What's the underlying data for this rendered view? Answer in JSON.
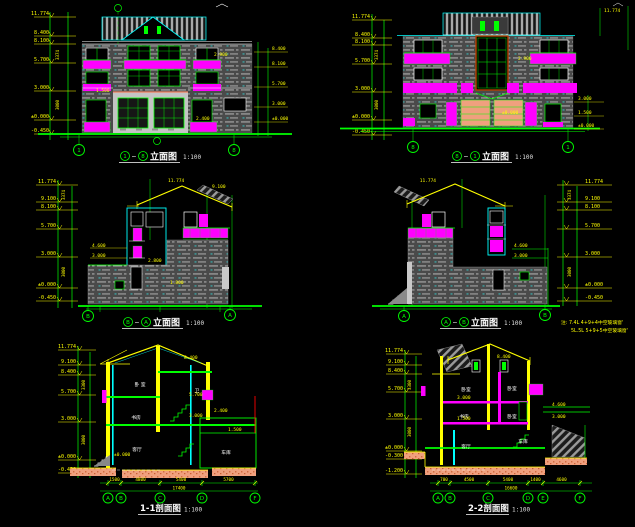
{
  "app": {
    "name": "cad-drawing-sheet",
    "background": "#000000"
  },
  "colors": {
    "line_green": "#00ff00",
    "dim_yellow": "#ffff00",
    "magenta": "#ff00ff",
    "cyan": "#00ffff",
    "white": "#ffffff",
    "wall_gray": "#4a4a4a",
    "light_wall": "#c4c4c4",
    "salmon": "#f0a07e",
    "frame_red": "#b44000"
  },
  "panels": {
    "front_elev": {
      "title": {
        "left_bubble": "1",
        "sep": "~",
        "right_bubble": "8",
        "name": "立面图",
        "scale": "1:100"
      },
      "axis_bubbles": [
        "1",
        "8"
      ],
      "levels_left": [
        "11.774",
        "8.400",
        "8.100",
        "5.700",
        "3.000",
        "±0.000",
        "-0.450"
      ],
      "levels_right": [
        "8.400",
        "8.100",
        "5.700",
        "3.000",
        "±0.000"
      ],
      "chain_dims": [
        "3374",
        "3000"
      ],
      "callouts": [
        "2.900",
        "1.500",
        "2.400"
      ]
    },
    "rear_elev": {
      "title": {
        "left_bubble": "8",
        "sep": "~",
        "right_bubble": "1",
        "name": "立面图",
        "scale": "1:100"
      },
      "axis_bubbles": [
        "8",
        "1"
      ],
      "levels_left": [
        "11.774",
        "8.400",
        "8.100",
        "5.700",
        "3.000",
        "±0.000",
        "-0.450"
      ],
      "levels_right": [
        "3.000",
        "1.500",
        "±0.000"
      ],
      "chain_dims": [
        "3374",
        "3000"
      ],
      "callouts": [
        "11.774",
        "2.900",
        "±0.000"
      ]
    },
    "left_elev": {
      "title": {
        "left_bubble": "B",
        "sep": "~",
        "right_bubble": "A",
        "name": "立面图",
        "scale": "1:100"
      },
      "axis_bubbles": [
        "B",
        "A"
      ],
      "levels_left": [
        "11.774",
        "9.100",
        "8.100",
        "5.700",
        "3.000",
        "±0.000",
        "-0.450"
      ],
      "chain_dims": [
        "3374",
        "3000"
      ],
      "callouts": [
        "11.774",
        "9.100",
        "4.600",
        "3.000",
        "2.800",
        "1.800"
      ]
    },
    "right_elev": {
      "title": {
        "left_bubble": "A",
        "sep": "~",
        "right_bubble": "B",
        "name": "立面图",
        "scale": "1:100"
      },
      "axis_bubbles": [
        "A",
        "B"
      ],
      "levels_right": [
        "11.774",
        "9.100",
        "8.100",
        "5.700",
        "3.000",
        "±0.000",
        "-0.450"
      ],
      "chain_dims": [
        "3374",
        "3000"
      ],
      "callouts": [
        "11.774",
        "4.600",
        "3.000"
      ],
      "note_line1": "注: 7.4L 4+9+4中空玻璃窗'",
      "note_line2": "5L.5L 5+9+5中空玻璃窗'"
    },
    "section_1": {
      "title": {
        "name": "1-1剖面图",
        "scale": "1:100"
      },
      "axis_bubbles": [
        "A",
        "B",
        "C",
        "D",
        "F"
      ],
      "levels_left": [
        "11.774",
        "9.100",
        "8.400",
        "5.700",
        "3.000",
        "±0.000",
        "-0.450"
      ],
      "chain_dims": [
        "3300",
        "3000"
      ],
      "rooms": [
        "卧 室",
        "书房",
        "客厅",
        "车库",
        "卫"
      ],
      "callouts": [
        "8.400",
        "5.700",
        "3.000",
        "2.400",
        "1.500",
        "±0.000"
      ],
      "dims": [
        "1500",
        "4800",
        "5400",
        "5700"
      ],
      "total_dim": "17400"
    },
    "section_2": {
      "title": {
        "name": "2-2剖面图",
        "scale": "1:100"
      },
      "axis_bubbles": [
        "A",
        "B",
        "C",
        "D",
        "E",
        "F"
      ],
      "levels_left": [
        "11.774",
        "9.100",
        "8.400",
        "5.700",
        "3.000",
        "±0.000",
        "-0.300",
        "-1.200"
      ],
      "chain_dims": [
        "3300",
        "3000"
      ],
      "rooms": [
        "卧室",
        "卧室",
        "书房",
        "卧室",
        "客厅",
        "车库"
      ],
      "callouts": [
        "8.400",
        "3.000",
        "1.500",
        "4.600",
        "3.000"
      ],
      "dims": [
        "700",
        "4500",
        "5400",
        "1400",
        "4600"
      ],
      "total_dim": "16600"
    }
  }
}
